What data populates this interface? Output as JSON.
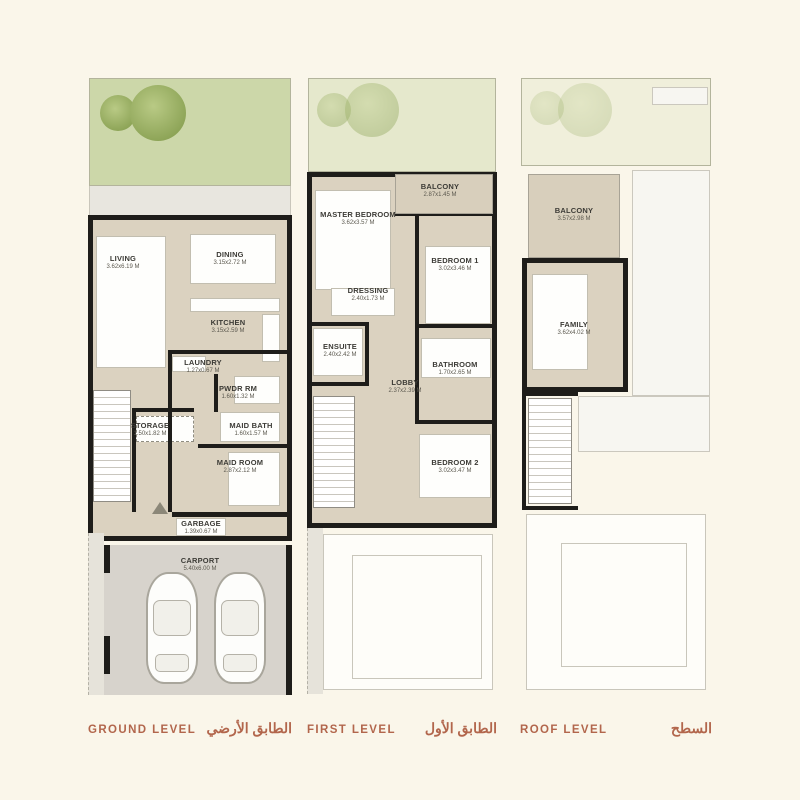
{
  "palette": {
    "background": "#faf6ea",
    "legend_label": "#b2664c",
    "wall": "#1e1d1a",
    "floor": "#dbd2c0",
    "garden_green": "#ccd7a9",
    "carport_gray": "#d7d3cc"
  },
  "plans": {
    "ground": {
      "title_en": "GROUND LEVEL",
      "title_ar": "الطابق الأرضي",
      "rooms": [
        {
          "label": "LIVING",
          "dims": "3.62x6.19 M"
        },
        {
          "label": "DINING",
          "dims": "3.15x2.72 M"
        },
        {
          "label": "KITCHEN",
          "dims": "3.15x2.59 M"
        },
        {
          "label": "LAUNDRY",
          "dims": "1.27x0.67 M"
        },
        {
          "label": "PWDR RM",
          "dims": "1.60x1.32 M"
        },
        {
          "label": "STORAGE",
          "dims": "1.50x1.82 M"
        },
        {
          "label": "MAID BATH",
          "dims": "1.60x1.57 M"
        },
        {
          "label": "MAID ROOM",
          "dims": "2.87x2.12 M"
        },
        {
          "label": "GARBAGE",
          "dims": "1.39x0.67 M"
        },
        {
          "label": "CARPORT",
          "dims": "5.40x6.00 M"
        }
      ]
    },
    "first": {
      "title_en": "FIRST LEVEL",
      "title_ar": "الطابق الأول",
      "rooms": [
        {
          "label": "BALCONY",
          "dims": "2.87x1.45 M"
        },
        {
          "label": "MASTER BEDROOM",
          "dims": "3.62x3.57 M"
        },
        {
          "label": "BEDROOM 1",
          "dims": "3.02x3.46 M"
        },
        {
          "label": "DRESSING",
          "dims": "2.40x1.73 M"
        },
        {
          "label": "ENSUITE",
          "dims": "2.40x2.42 M"
        },
        {
          "label": "LOBBY",
          "dims": "2.37x2.39 M"
        },
        {
          "label": "BATHROOM",
          "dims": "1.70x2.65 M"
        },
        {
          "label": "BEDROOM 2",
          "dims": "3.02x3.47 M"
        }
      ]
    },
    "roof": {
      "title_en": "ROOF LEVEL",
      "title_ar": "السطح",
      "rooms": [
        {
          "label": "BALCONY",
          "dims": "3.57x2.98 M"
        },
        {
          "label": "FAMILY",
          "dims": "3.62x4.02 M"
        }
      ]
    }
  }
}
